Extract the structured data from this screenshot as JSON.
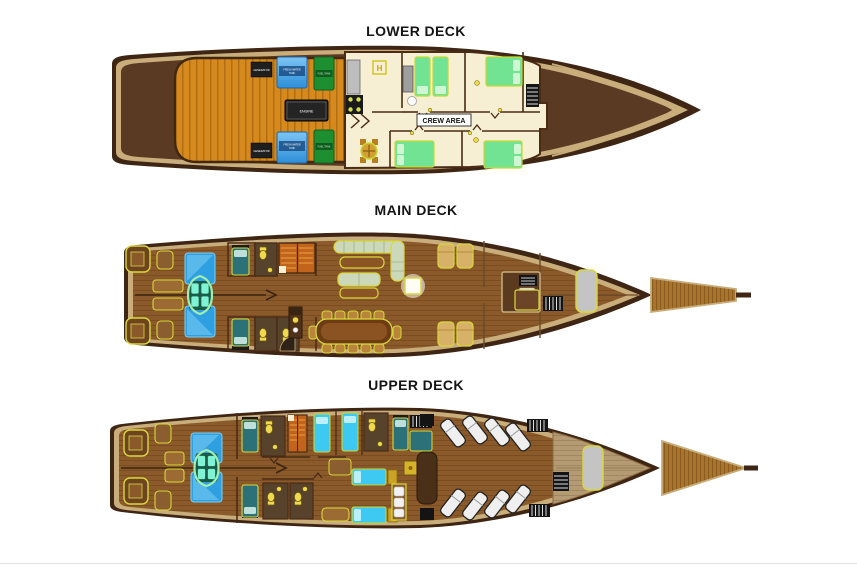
{
  "figure_type": "liveaboard-boat-deck-plans",
  "decks": {
    "lower": {
      "title": "LOWER DECK",
      "labels": {
        "crew_area": "CREW AREA",
        "engine": "ENGINE",
        "generator": "GENERATOR",
        "fresh_water_line1": "FRESH WATER",
        "fresh_water_line2": "TANK",
        "fuel_tank": "FUEL TANK",
        "galley_hatch": "H"
      }
    },
    "main": {
      "title": "MAIN DECK"
    },
    "upper": {
      "title": "UPPER DECK"
    }
  },
  "colors": {
    "hull_dark": "#3F2614",
    "trim_tan": "#C9AE7C",
    "deck_wood": "#8B5A2B",
    "engine_room_orange": "#D6891C",
    "room_cream": "#F6EFD3",
    "tank_blue": "#2E8FD8",
    "tank_green": "#1E8F31",
    "bed_green": "#71E392",
    "bed_teal": "#2C7078",
    "bed_cyan": "#3EC9F2",
    "sun_pad_blue": "#2E9FE0",
    "fixture_yellow": "#EFD94F",
    "stairs_orange": "#C2641C",
    "lounger_white": "#EFEFEF"
  }
}
